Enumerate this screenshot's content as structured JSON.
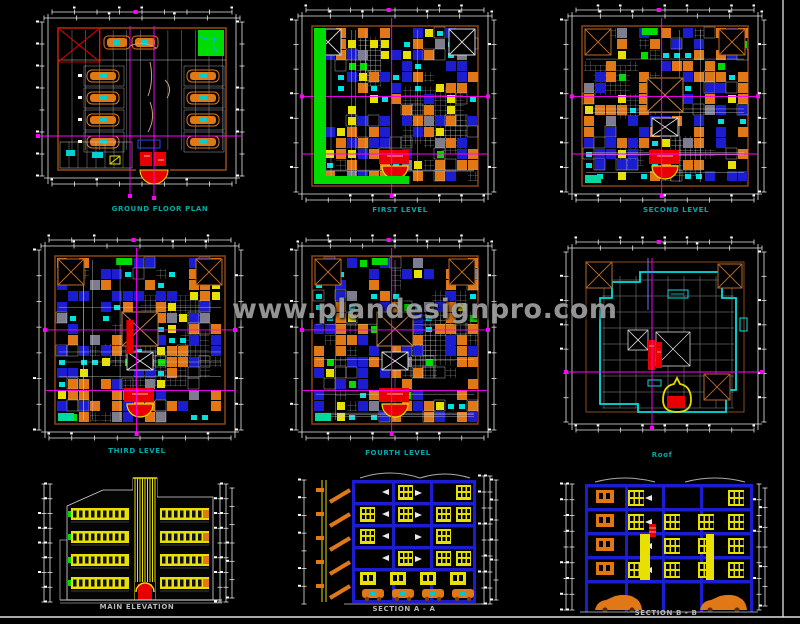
{
  "watermark": {
    "text": "www.plandesignpro.com",
    "color": "#a0a0a0"
  },
  "palette": {
    "background": "#000000",
    "dim_line": "#e8e8e8",
    "grid_line": "#ff00ff",
    "wall_brown": "#8a4516",
    "orange": "#e07818",
    "blue": "#1d1dd0",
    "cyan": "#00e0e0",
    "green": "#00dc00",
    "yellow": "#e8e000",
    "red": "#e80000",
    "gray_hatch": "#cfcfcf",
    "tan": "#c08040",
    "plan_label": "#00a8a8",
    "section_label": "#c0c0c0",
    "sheet_border": "#e0e0e0"
  },
  "panels": [
    {
      "id": "ground-floor-plan",
      "label": "GROUND FLOOR PLAN",
      "label_color": "#00a8a8",
      "drawing_type": "parking-floor-plan"
    },
    {
      "id": "first-level",
      "label": "FIRST LEVEL",
      "label_color": "#00a8a8",
      "drawing_type": "floor-plan"
    },
    {
      "id": "second-level",
      "label": "SECOND LEVEL",
      "label_color": "#00a8a8",
      "drawing_type": "floor-plan"
    },
    {
      "id": "third-level",
      "label": "THIRD LEVEL",
      "label_color": "#00a8a8",
      "drawing_type": "floor-plan"
    },
    {
      "id": "fourth-level",
      "label": "FOURTH LEVEL",
      "label_color": "#00a8a8",
      "drawing_type": "floor-plan"
    },
    {
      "id": "roof",
      "label": "Roof",
      "label_color": "#00a8a8",
      "drawing_type": "roof-plan"
    },
    {
      "id": "main-elevation",
      "label": "MAIN ELEVATION",
      "label_color": "#b8b8b8",
      "drawing_type": "elevation"
    },
    {
      "id": "section-a-a",
      "label": "SECTION A - A",
      "label_color": "#b8b8b8",
      "drawing_type": "section"
    },
    {
      "id": "section-b-b",
      "label": "SECTION B - B",
      "label_color": "#b8b8b8",
      "drawing_type": "section"
    }
  ]
}
